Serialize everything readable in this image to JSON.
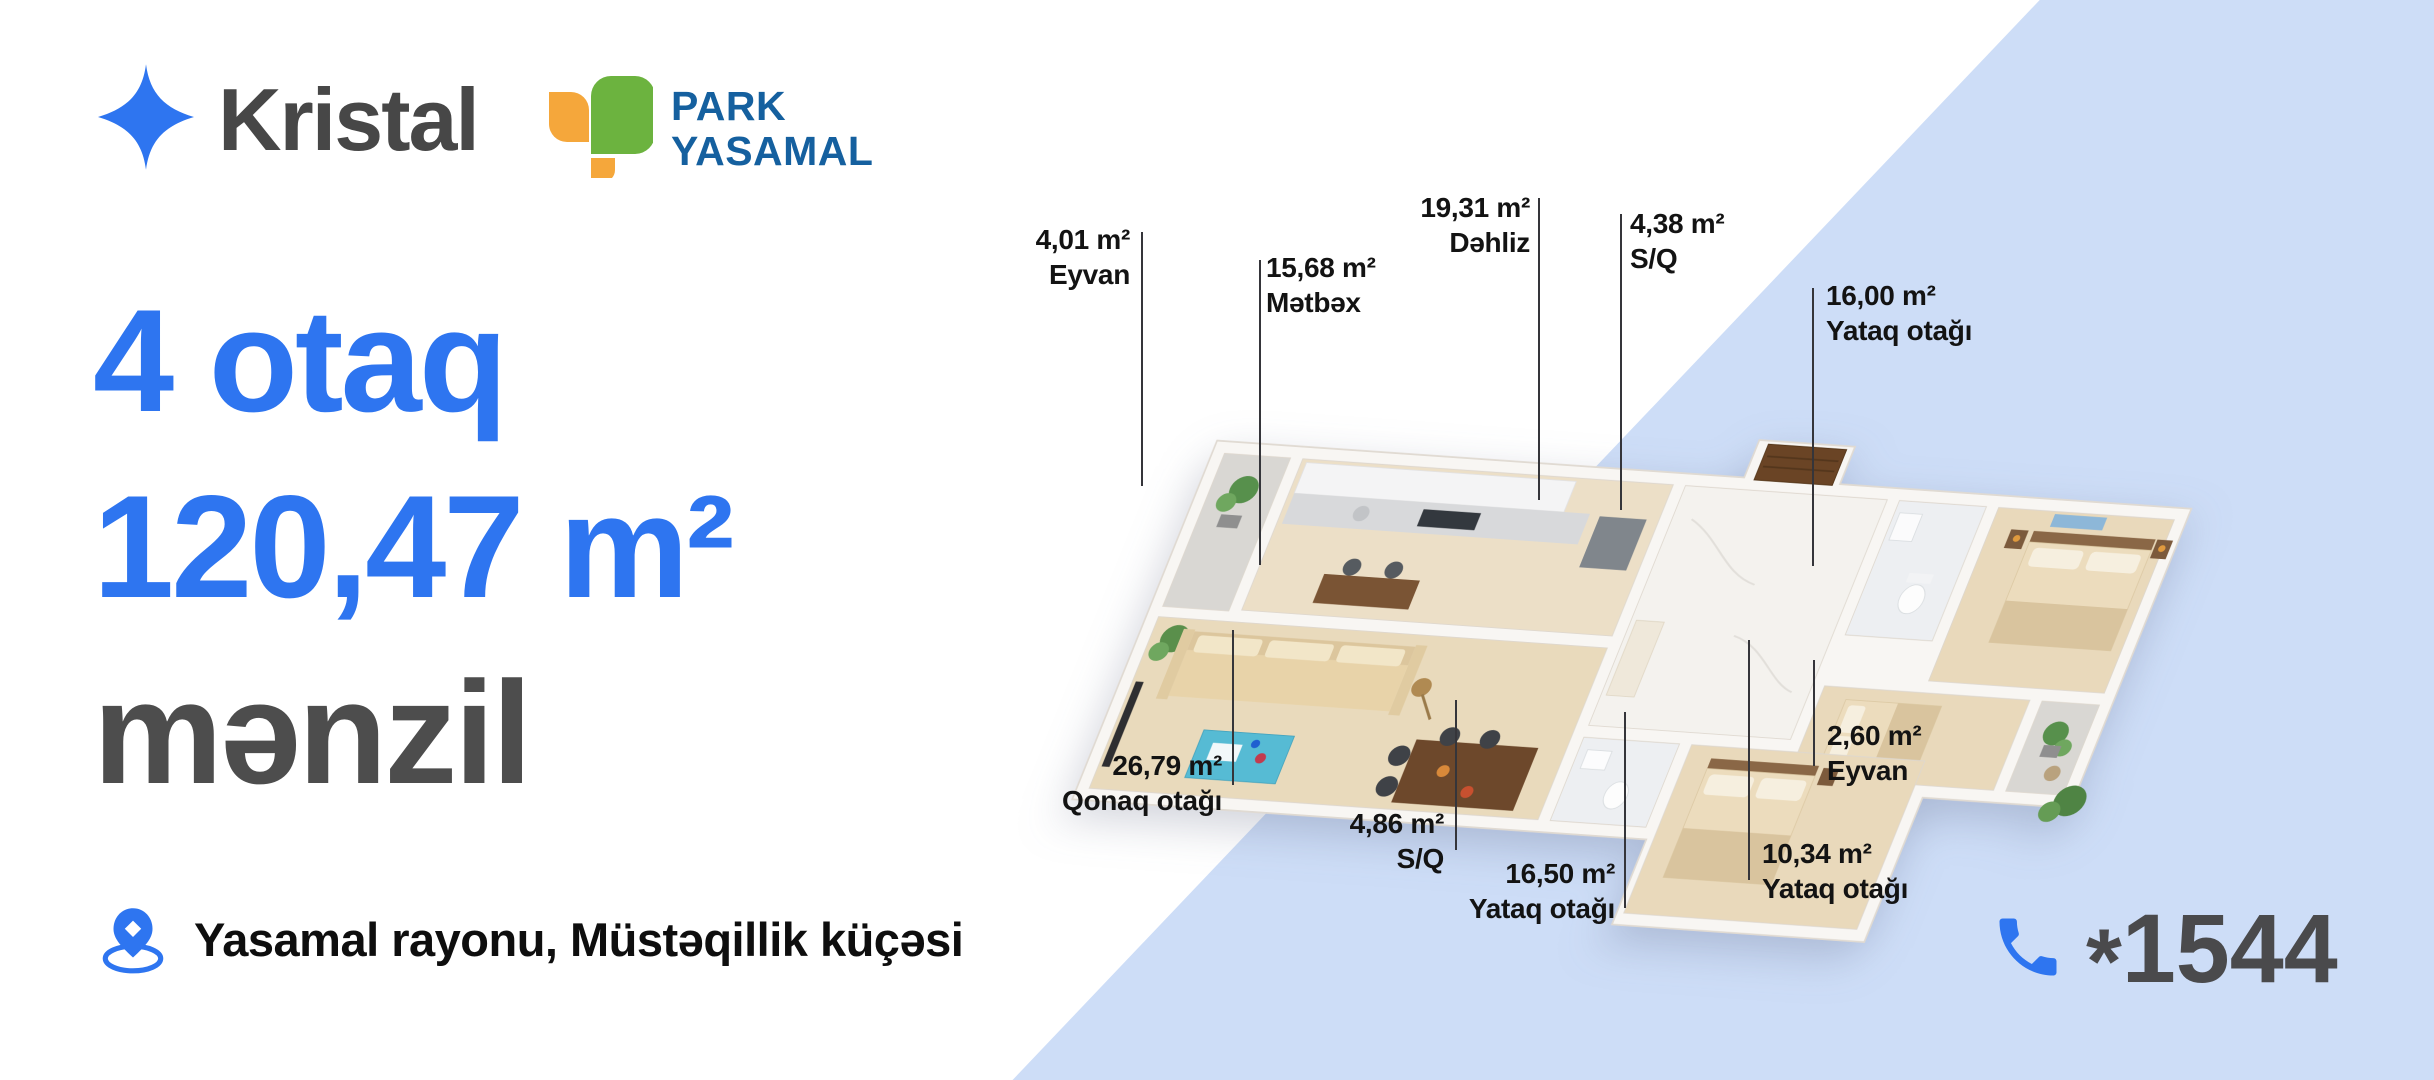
{
  "brand": {
    "name": "Kristal"
  },
  "developer": {
    "line1": "PARK",
    "line2": "YASAMAL"
  },
  "headline": {
    "rooms": "4 otaq",
    "area": "120,47 m²",
    "type": "mənzil"
  },
  "location": {
    "text": "Yasamal rayonu, Müstəqillik küçəsi"
  },
  "contact": {
    "phone_star": "*",
    "phone_digits": "1544"
  },
  "colors": {
    "accent_blue": "#2E75F0",
    "panel_blue": "#CDDDF7",
    "headline_gray": "#4D4D4D",
    "brand_gray": "#474747",
    "developer_navy": "#15609F",
    "leaf_green": "#6CB33F",
    "leaf_orange": "#F5A73B"
  },
  "floor_plan": {
    "rooms": [
      {
        "area": "4,01 m²",
        "name": "Eyvan"
      },
      {
        "area": "15,68 m²",
        "name": "Mətbəx"
      },
      {
        "area": "19,31 m²",
        "name": "Dəhliz"
      },
      {
        "area": "4,38 m²",
        "name": "S/Q"
      },
      {
        "area": "16,00 m²",
        "name": "Yataq otağı"
      },
      {
        "area": "26,79 m²",
        "name": "Qonaq otağı"
      },
      {
        "area": "4,86 m²",
        "name": "S/Q"
      },
      {
        "area": "16,50 m²",
        "name": "Yataq otağı"
      },
      {
        "area": "10,34 m²",
        "name": "Yataq otağı"
      },
      {
        "area": "2,60 m²",
        "name": "Eyvan"
      }
    ]
  }
}
